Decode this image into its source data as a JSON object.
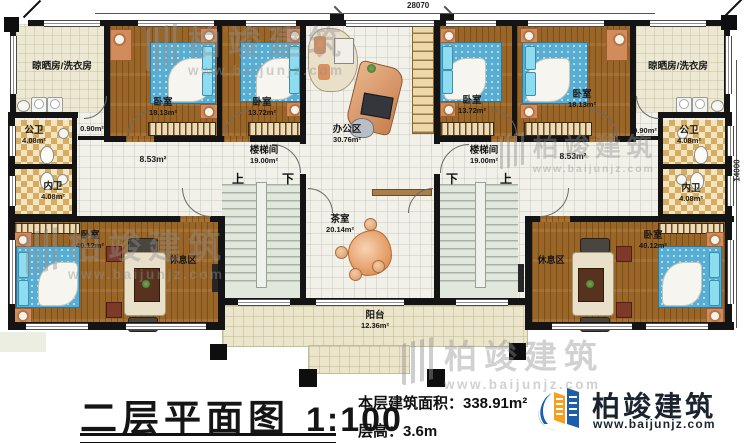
{
  "dimensions": {
    "top_width": "28070",
    "right_height": "14000"
  },
  "rooms": {
    "laundry": "晾晒房/洗衣房",
    "bedroom": "卧室",
    "office": "办公区",
    "stairwell": "楼梯间",
    "pub_bath": "公卫",
    "priv_bath": "内卫",
    "lounge": "休息区",
    "tea": "茶室",
    "balcony": "阳台"
  },
  "areas": {
    "bedroom_large": "18.13m²",
    "bedroom_small": "13.72m²",
    "office": "30.76m²",
    "stairwell": "19.00m²",
    "bath": "4.08m²",
    "master": "40.12m²",
    "tea": "20.14m²",
    "balcony": "12.36m²",
    "corridor": "8.53m²",
    "closet": "0.90m²"
  },
  "stair": {
    "up": "上",
    "down": "下"
  },
  "footer": {
    "title": "二层平面图",
    "scale": "1:100",
    "area_text": "本层建筑面积：338.91m²",
    "height_text": "层高：3.6m",
    "brand": "柏竣建筑",
    "url": "www.baijunjz.com"
  },
  "watermark": {
    "brand": "柏竣建筑",
    "url": "www.baijunjz.com"
  }
}
